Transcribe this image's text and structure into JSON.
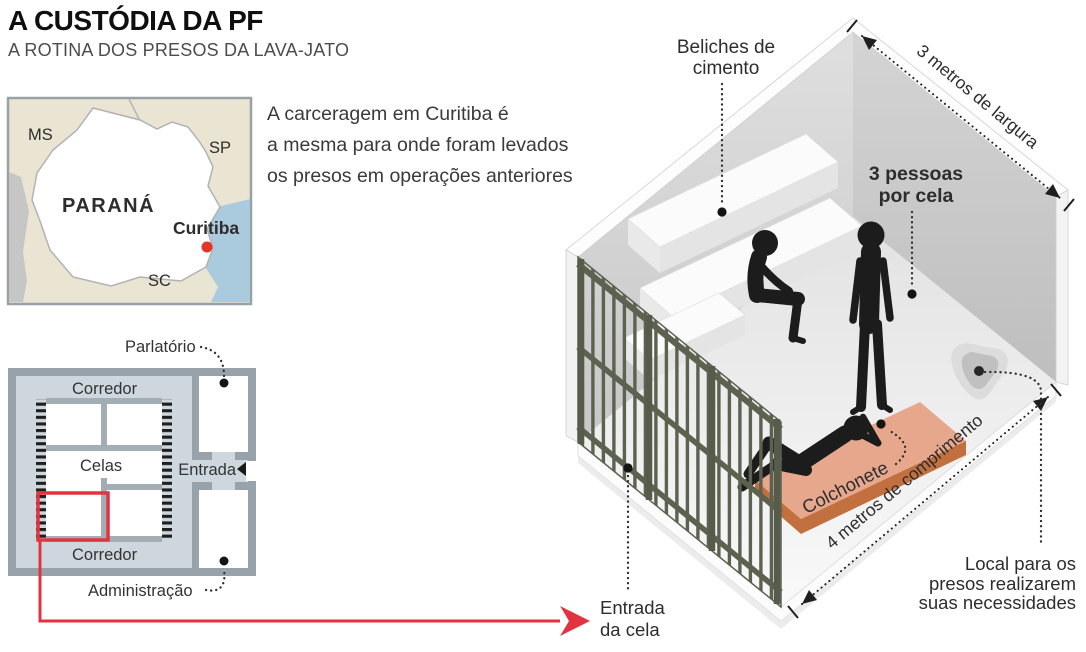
{
  "header": {
    "title": "A CUSTÓDIA DA PF",
    "subtitle": "A ROTINA DOS PRESOS DA LAVA-JATO"
  },
  "intro": {
    "lines": [
      "A carceragem em Curitiba é",
      "a mesma para onde foram levados",
      "os presos em operações anteriores"
    ]
  },
  "map": {
    "state": "PARANÁ",
    "city": "Curitiba",
    "neighbor_ms": "MS",
    "neighbor_sp": "SP",
    "neighbor_sc": "SC"
  },
  "floorplan": {
    "parlatorio": "Parlatório",
    "corredor_top": "Corredor",
    "celas": "Celas",
    "entrada": "Entrada",
    "corredor_bottom": "Corredor",
    "administracao": "Administração"
  },
  "cell": {
    "beliches": [
      "Beliches de",
      "cimento"
    ],
    "pessoas": [
      "3 pessoas",
      "por cela"
    ],
    "largura": "3 metros de largura",
    "comprimento": "4 metros de comprimento",
    "colchonete": "Colchonete",
    "entrada_cela": [
      "Entrada",
      "da cela"
    ],
    "local": [
      "Local para os",
      "presos realizarem",
      "suas necessidades"
    ]
  },
  "colors": {
    "accent_red": "#e23440",
    "map_land": "#e9e5d2",
    "map_water": "#aacbdd",
    "plan_fill": "#cdd7dd",
    "plan_wall": "#97a2aa",
    "bars": "#5d6250",
    "mattress_top": "#e7a78d",
    "mattress_side": "#c2703f"
  }
}
